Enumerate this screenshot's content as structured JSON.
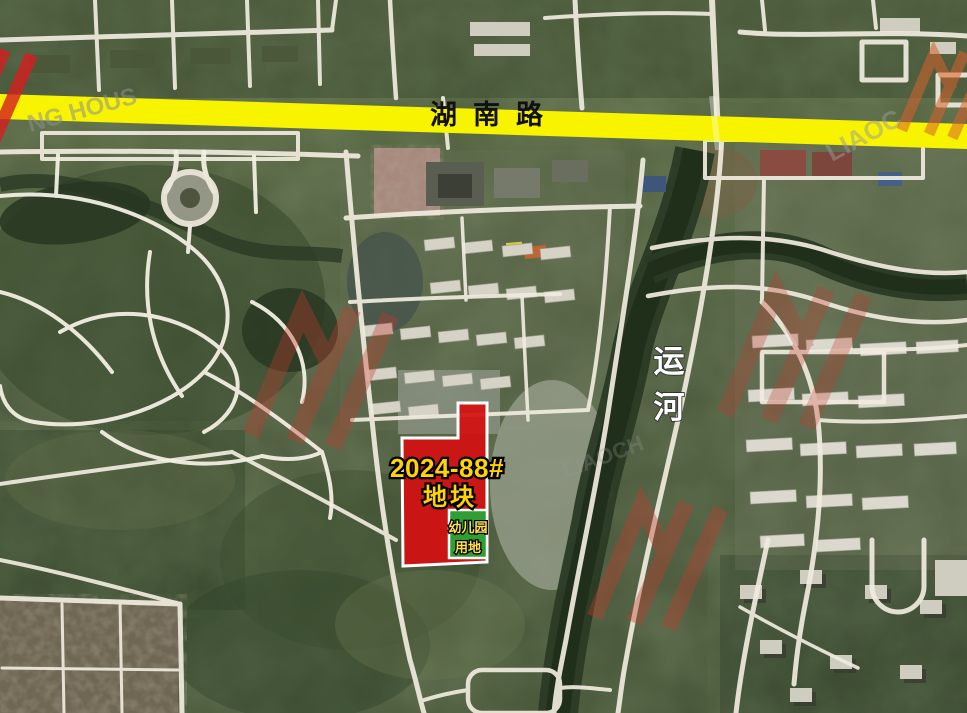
{
  "annotations": {
    "road_label": "湖南路",
    "canal_label_char1": "运",
    "canal_label_char2": "河",
    "parcel_code": "2024-88#",
    "parcel_word": "地块",
    "kindergarten_line1": "幼儿园",
    "kindergarten_line2": "用地"
  },
  "watermarks": {
    "fragment_topleft": "NG HOUS",
    "fragment_topright": "LIAOC",
    "fragment_middle": "LIAOCH"
  },
  "colors": {
    "highlight_road_yellow": "#f8f400",
    "road_label_text": "#111111",
    "parcel_fill_red": "#d31111",
    "parcel_border": "#ffffff",
    "parcel_label_yellow": "#ffd400",
    "kindergarten_fill_green": "#2f9e33",
    "kindergarten_label_yellow": "#ffe14d",
    "canal_label_white": "#ffffff",
    "watermark_logo_red": "#c23b2e",
    "watermark_text_gray": "#9a9a9a"
  }
}
